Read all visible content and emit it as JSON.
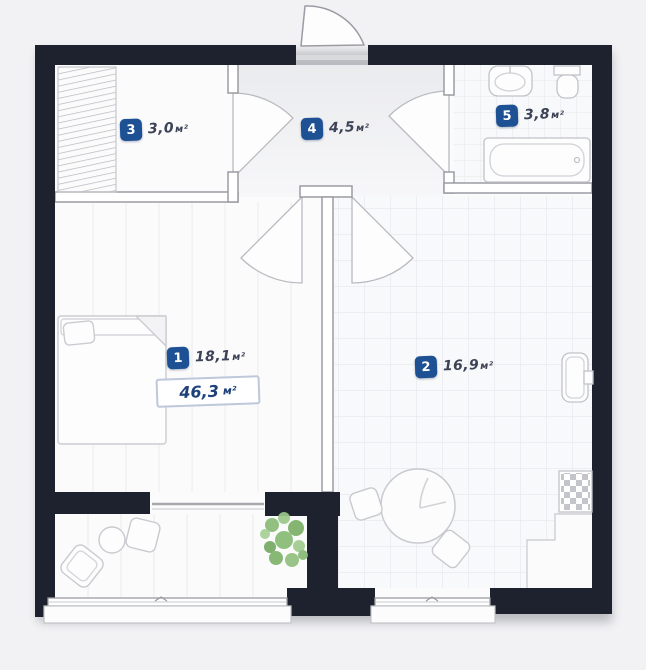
{
  "total": {
    "value": "46,3",
    "unit": "м²"
  },
  "rooms": [
    {
      "number": "1",
      "area": "18,1",
      "unit": "м²"
    },
    {
      "number": "2",
      "area": "16,9",
      "unit": "м²"
    },
    {
      "number": "3",
      "area": "3,0",
      "unit": "м²"
    },
    {
      "number": "4",
      "area": "4,5",
      "unit": "м²"
    },
    {
      "number": "5",
      "area": "3,8",
      "unit": "м²"
    }
  ],
  "colors": {
    "wall": "#1d222e",
    "badge_blue": "#1e5094",
    "total_text": "#1e417a",
    "plant_green": "#7db56c",
    "floor": "#fbfbfc"
  },
  "icons": [
    "bed-icon",
    "wardrobe-icon",
    "bathtub-icon",
    "toilet-icon",
    "bathroom-sink-icon",
    "kitchen-sink-icon",
    "stove-icon",
    "dining-table-icon",
    "chair-icon",
    "armchair-icon",
    "coffee-table-icon",
    "plant-icon",
    "door-swing-icon",
    "window-icon"
  ]
}
